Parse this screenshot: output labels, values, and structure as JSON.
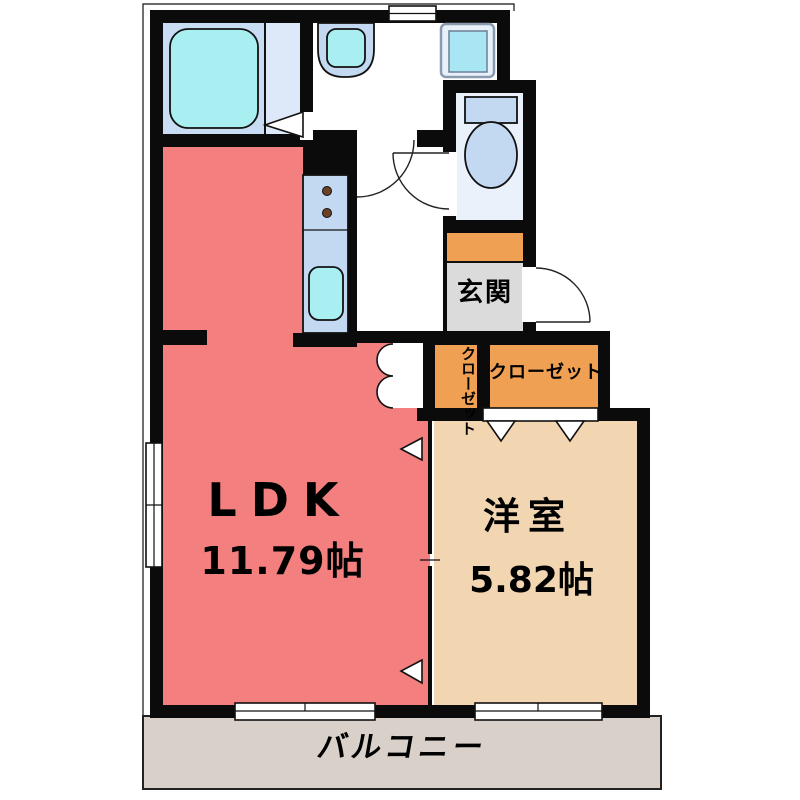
{
  "rooms": {
    "ldk": {
      "name": "LDK",
      "area": "11.79帖"
    },
    "western_room": {
      "name": "洋室",
      "area": "5.82帖"
    },
    "balcony": {
      "name": "バルコニー"
    },
    "entrance": {
      "name": "玄関"
    },
    "closet": {
      "name": "クローゼット"
    },
    "closet_small": {
      "name": "クローゼット"
    }
  },
  "fixtures": [
    {
      "name": "bathtub"
    },
    {
      "name": "vanity-sink"
    },
    {
      "name": "washing-machine-pan"
    },
    {
      "name": "toilet"
    },
    {
      "name": "kitchen-counter"
    },
    {
      "name": "gas-stove"
    },
    {
      "name": "kitchen-sink"
    }
  ],
  "colors": {
    "wall": "#0b0b0b",
    "ldk": "#f47f7f",
    "western": "#f2d6b2",
    "accent": "#f0a053",
    "genkan": "#dbdbdb",
    "balcony": "#d9d1c9",
    "bathblue": "#c8dcf3",
    "bathblue2": "#dde9f8",
    "fixture": "#c3d9f2",
    "water": "#a9eff1",
    "toiletroom": "#eaf1fa"
  }
}
